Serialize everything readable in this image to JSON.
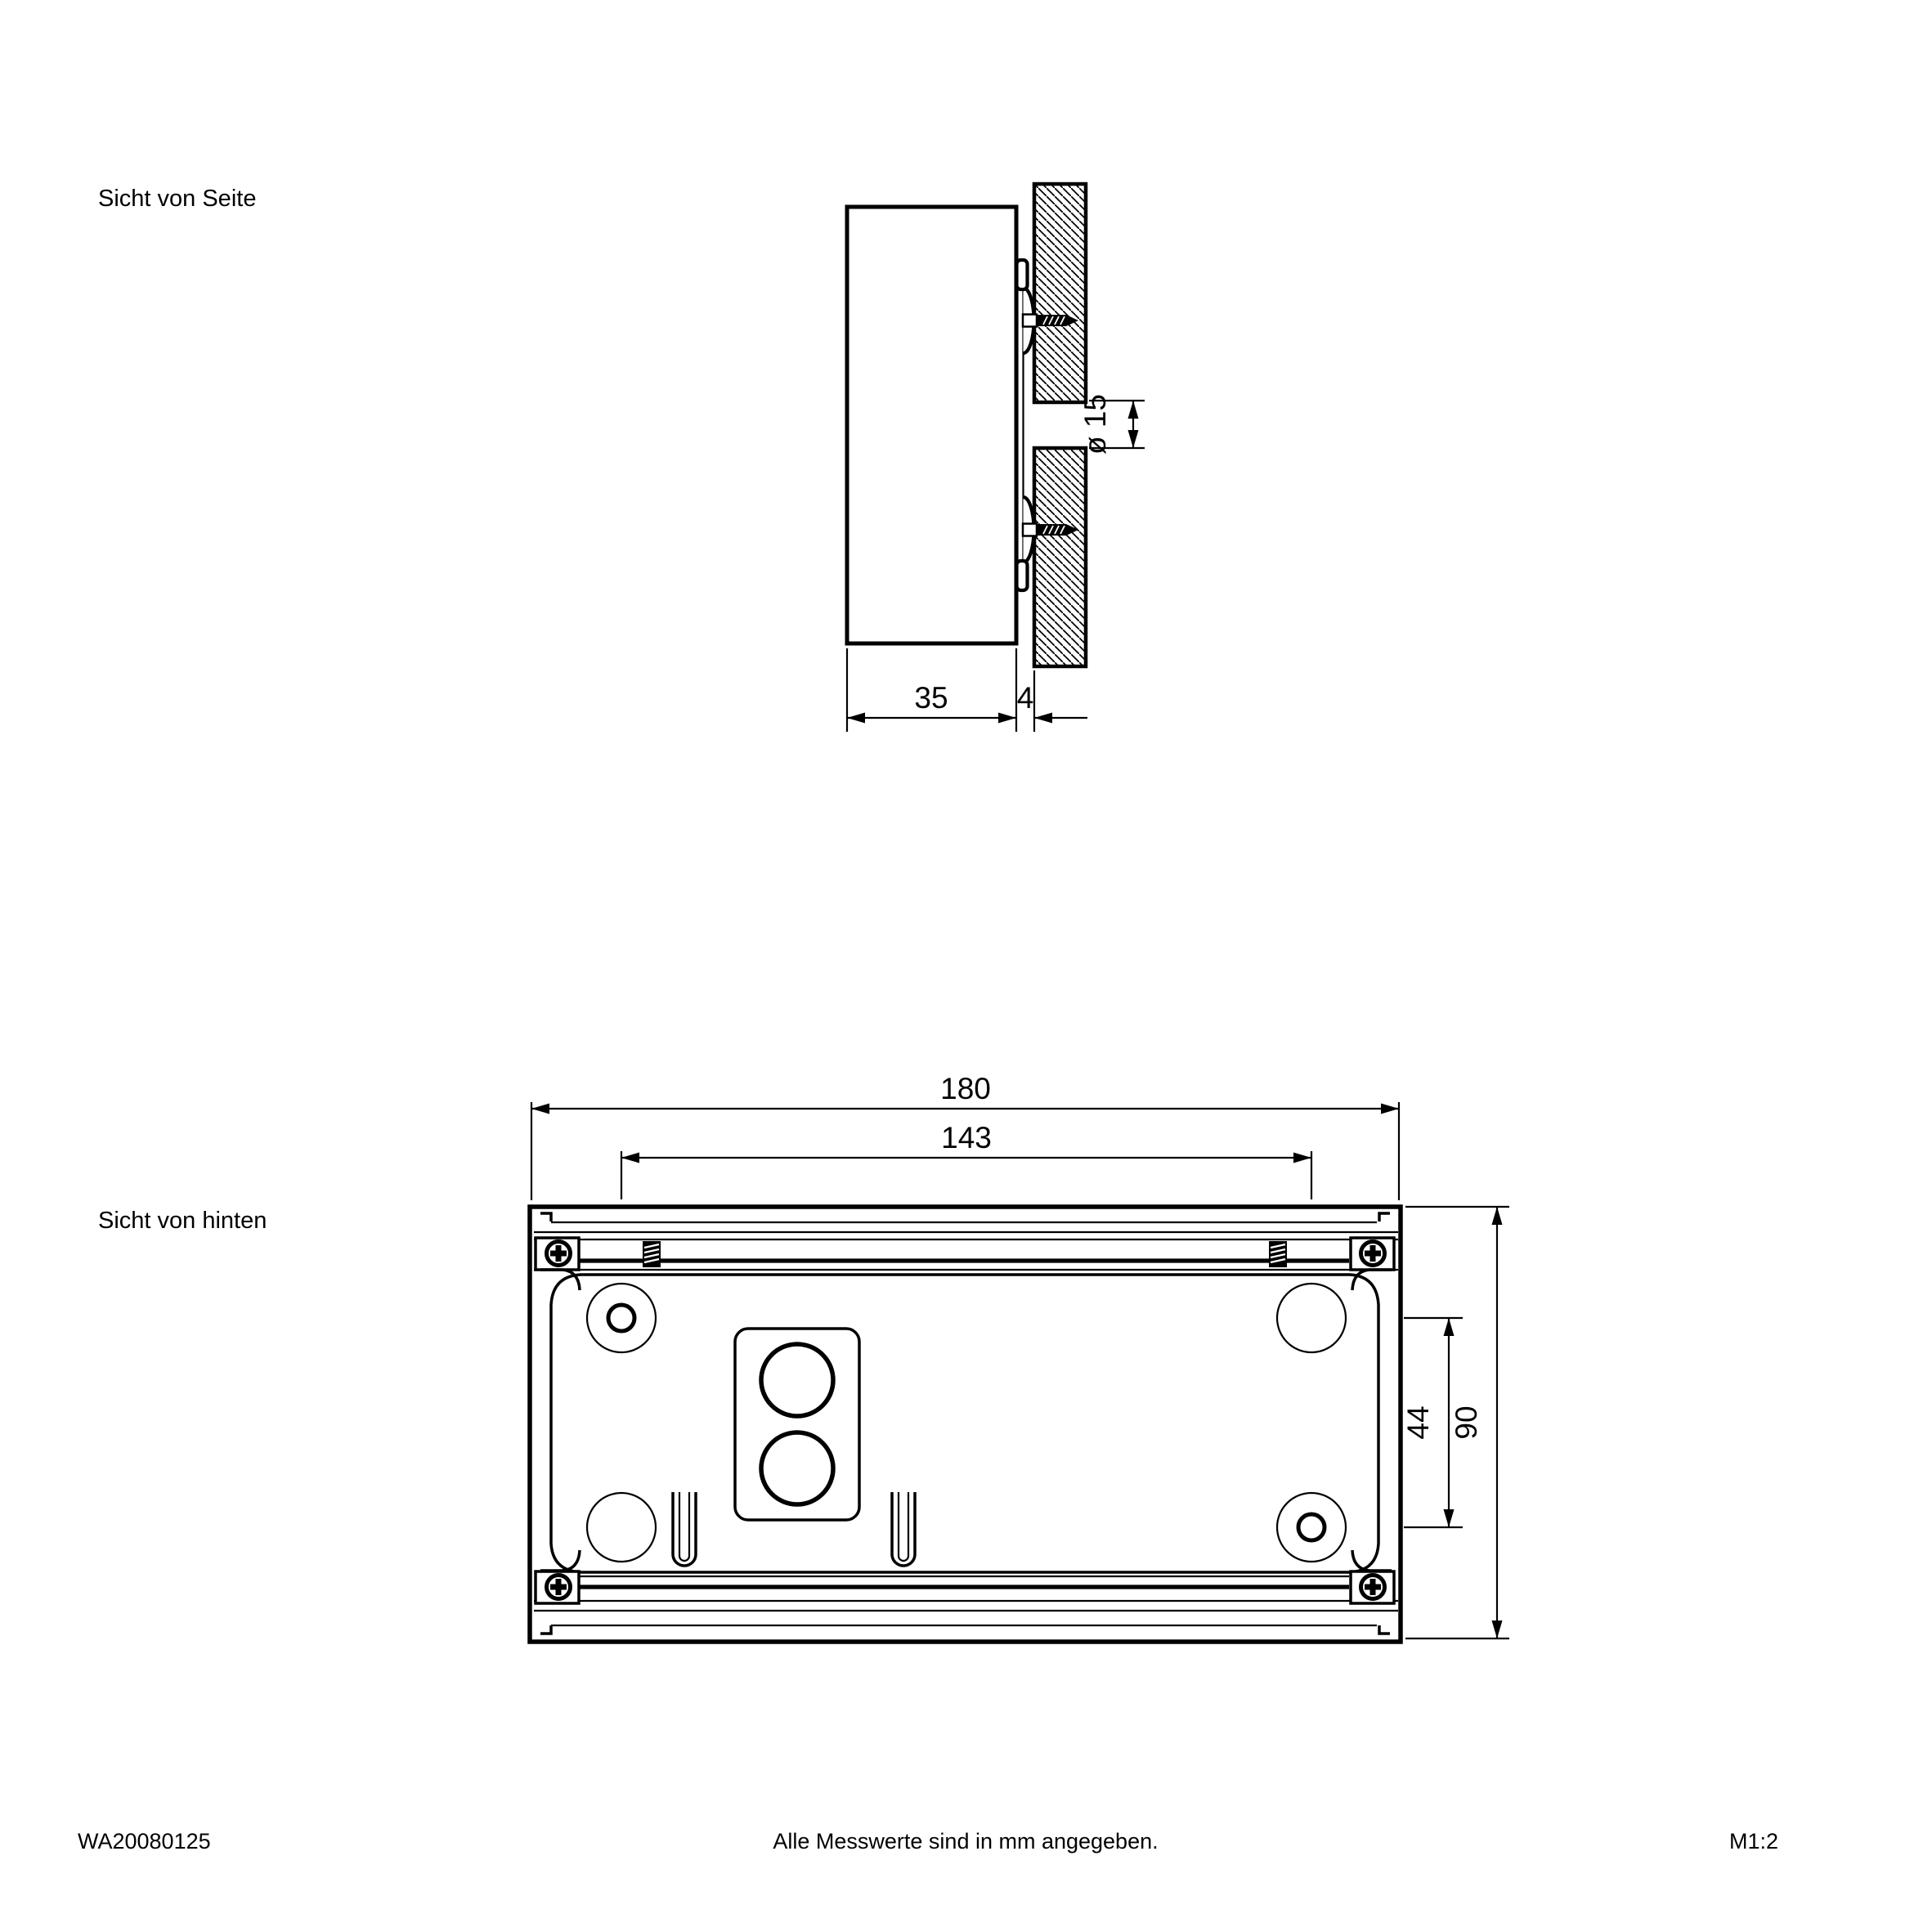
{
  "colors": {
    "ink": "#000000",
    "paper": "#ffffff"
  },
  "side_view": {
    "label": "Sicht von Seite",
    "dimensions": {
      "depth_mm": "35",
      "wall_offset_mm": "4",
      "cable_hole": "ø 15"
    }
  },
  "rear_view": {
    "label": "Sicht von hinten",
    "dimensions": {
      "width_mm": "180",
      "mount_spacing_h_mm": "143",
      "mount_spacing_v_mm": "44",
      "height_mm": "90"
    }
  },
  "footer": {
    "drawing_number": "WA20080125",
    "note": "Alle Messwerte sind in mm angegeben.",
    "scale": "M1:2"
  }
}
